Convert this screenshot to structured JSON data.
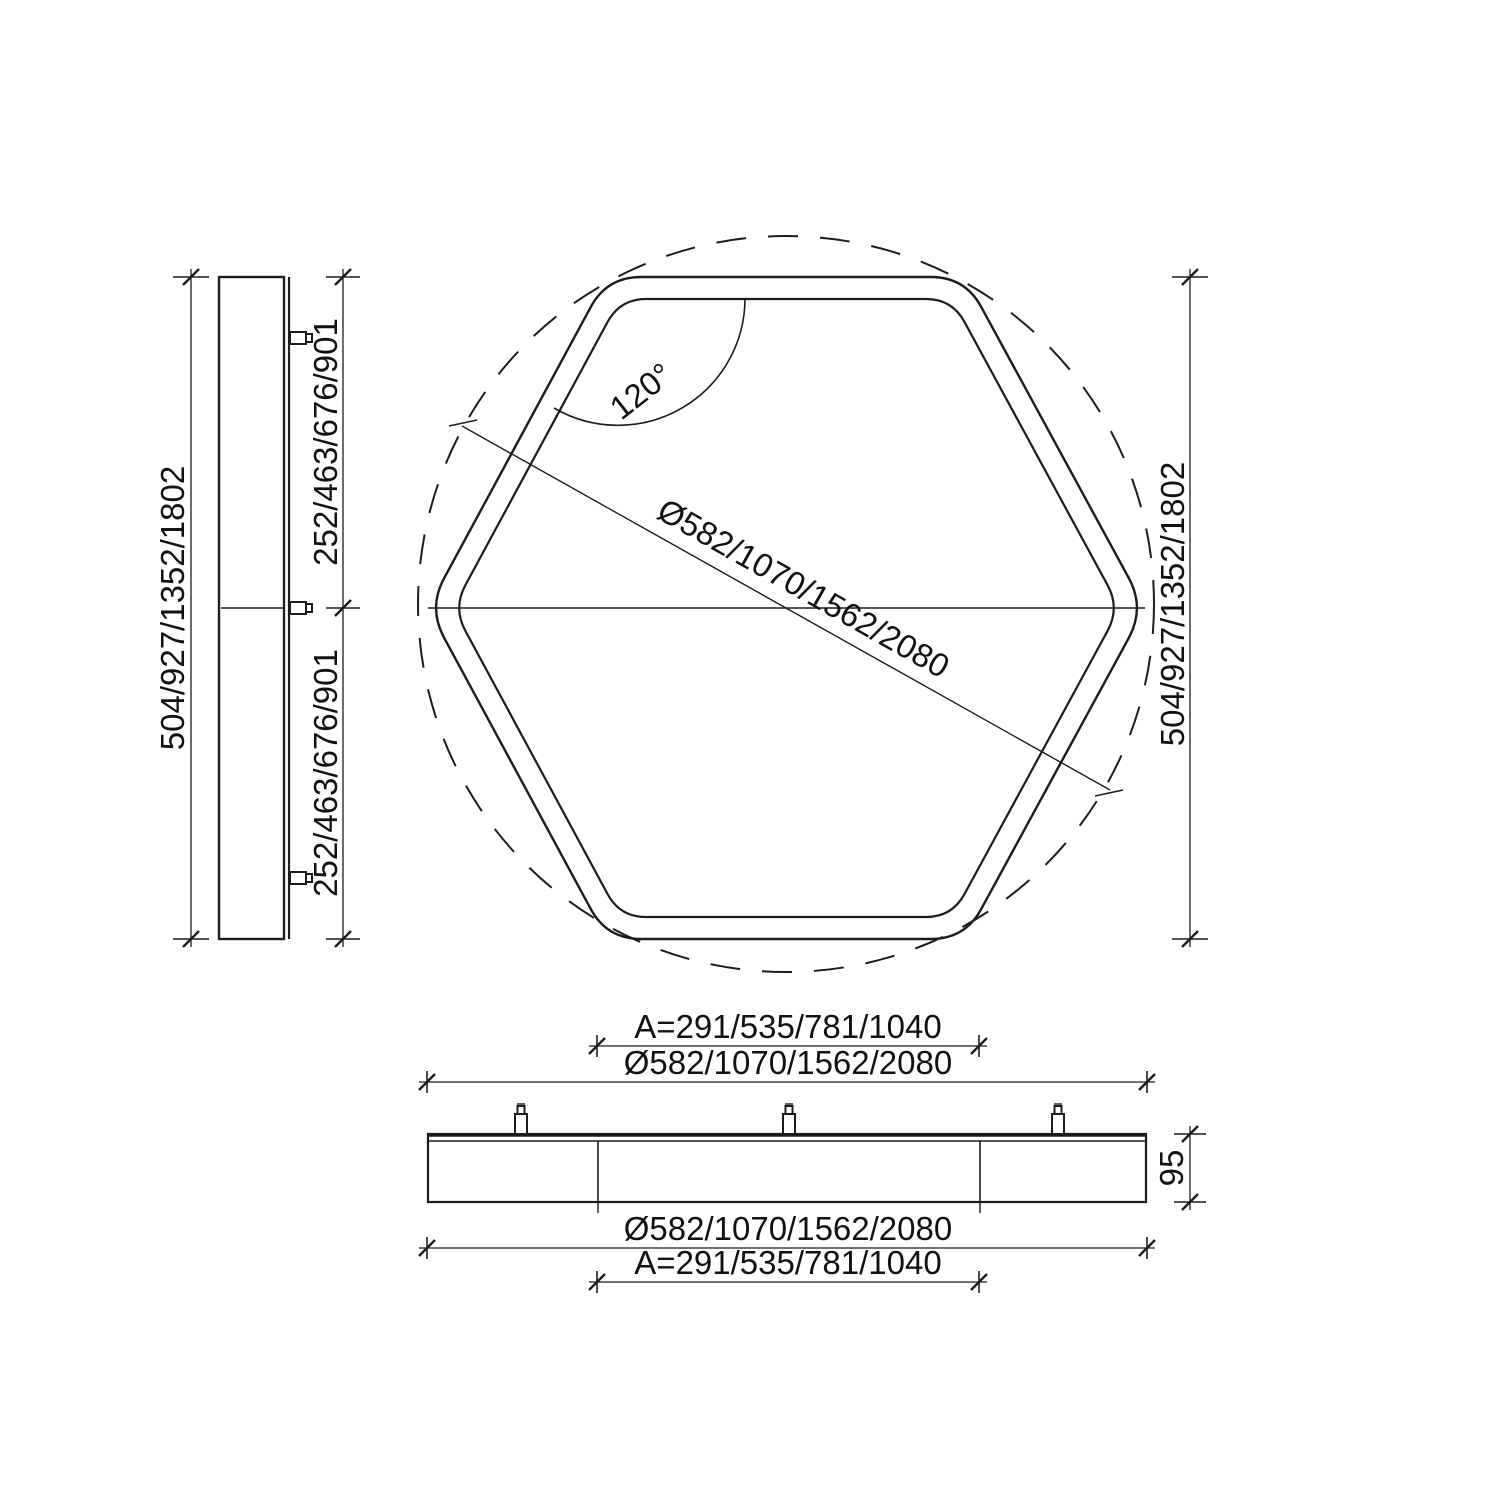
{
  "drawing": {
    "title": "Hexagonal luminaire dimensional drawing",
    "colors": {
      "line": "#1c1c1c",
      "background": "#ffffff"
    },
    "side_view": {
      "height_label": "504/927/1352/1802",
      "half_height_top_label": "252/463/676/901",
      "half_height_bottom_label": "252/463/676/901"
    },
    "top_view": {
      "angle_label": "120°",
      "diameter_label": "Ø582/1070/1562/2080",
      "height_label": "504/927/1352/1802"
    },
    "front_view": {
      "a_top_label": "A=291/535/781/1040",
      "diameter_top_label": "Ø582/1070/1562/2080",
      "diameter_bottom_label": "Ø582/1070/1562/2080",
      "a_bottom_label": "A=291/535/781/1040",
      "thickness_label": "95"
    }
  }
}
